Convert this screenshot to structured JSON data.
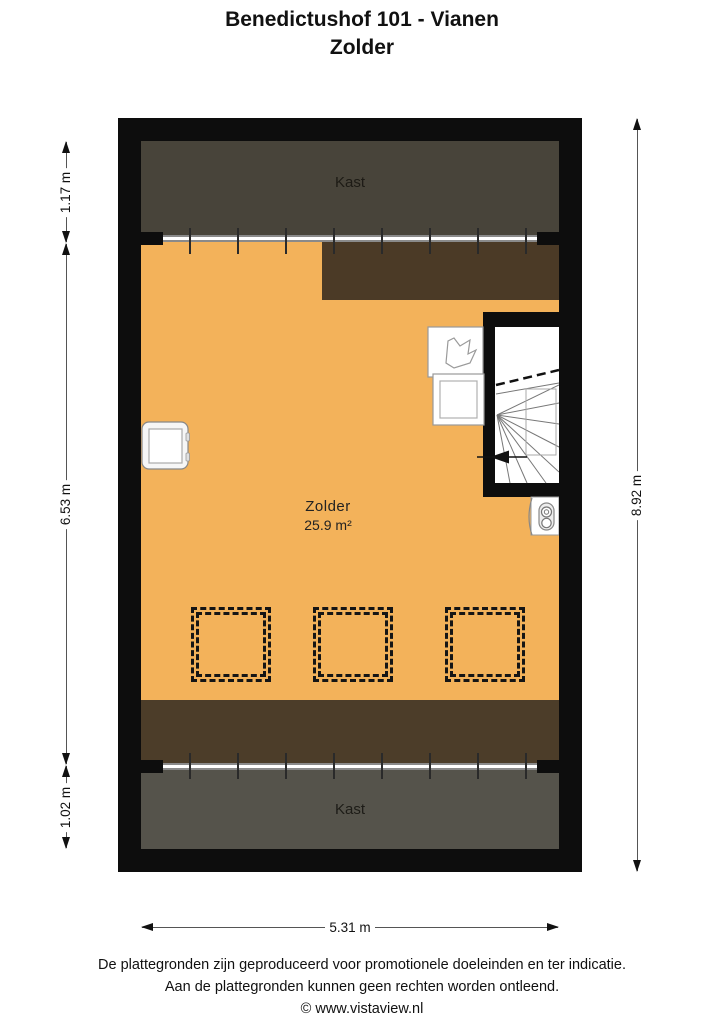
{
  "title": {
    "line1": "Benedictushof 101 - Vianen",
    "line2": "Zolder"
  },
  "rooms": {
    "kast_top": {
      "label": "Kast"
    },
    "zolder": {
      "label": "Zolder",
      "area": "25.9 m²"
    },
    "kast_bottom": {
      "label": "Kast"
    }
  },
  "dimensions": {
    "left_top": "1.17 m",
    "left_middle": "6.53 m",
    "left_bottom": "1.02 m",
    "right": "8.92 m",
    "bottom": "5.31 m"
  },
  "footer": {
    "line1": "De plattegronden zijn geproduceerd voor promotionele doeleinden en ter indicatie.",
    "line2": "Aan de plattegronden kunnen geen rechten worden ontleend.",
    "line3": "© www.vistaview.nl"
  },
  "colors": {
    "floor_orange": "#F3B25A",
    "wall_black": "#0D0D0D",
    "kast_top_fill": "#48443A",
    "roof_slope_top_fill": "#4B3A26",
    "roof_slope_bottom_fill": "#4C3D29",
    "kast_bottom_fill": "#55534B"
  },
  "icons": {
    "stairs": "winder-staircase fan lines with down arrow",
    "stairs_down_arrow": "solid left-pointing triangle",
    "skylight": "double dashed square",
    "washing_machine": "rounded square with inner square",
    "sink": "hand-drawn basin outline in white box",
    "worktop_unit": "white box with inner square",
    "boiler": "rounded rectangle with two circles"
  }
}
